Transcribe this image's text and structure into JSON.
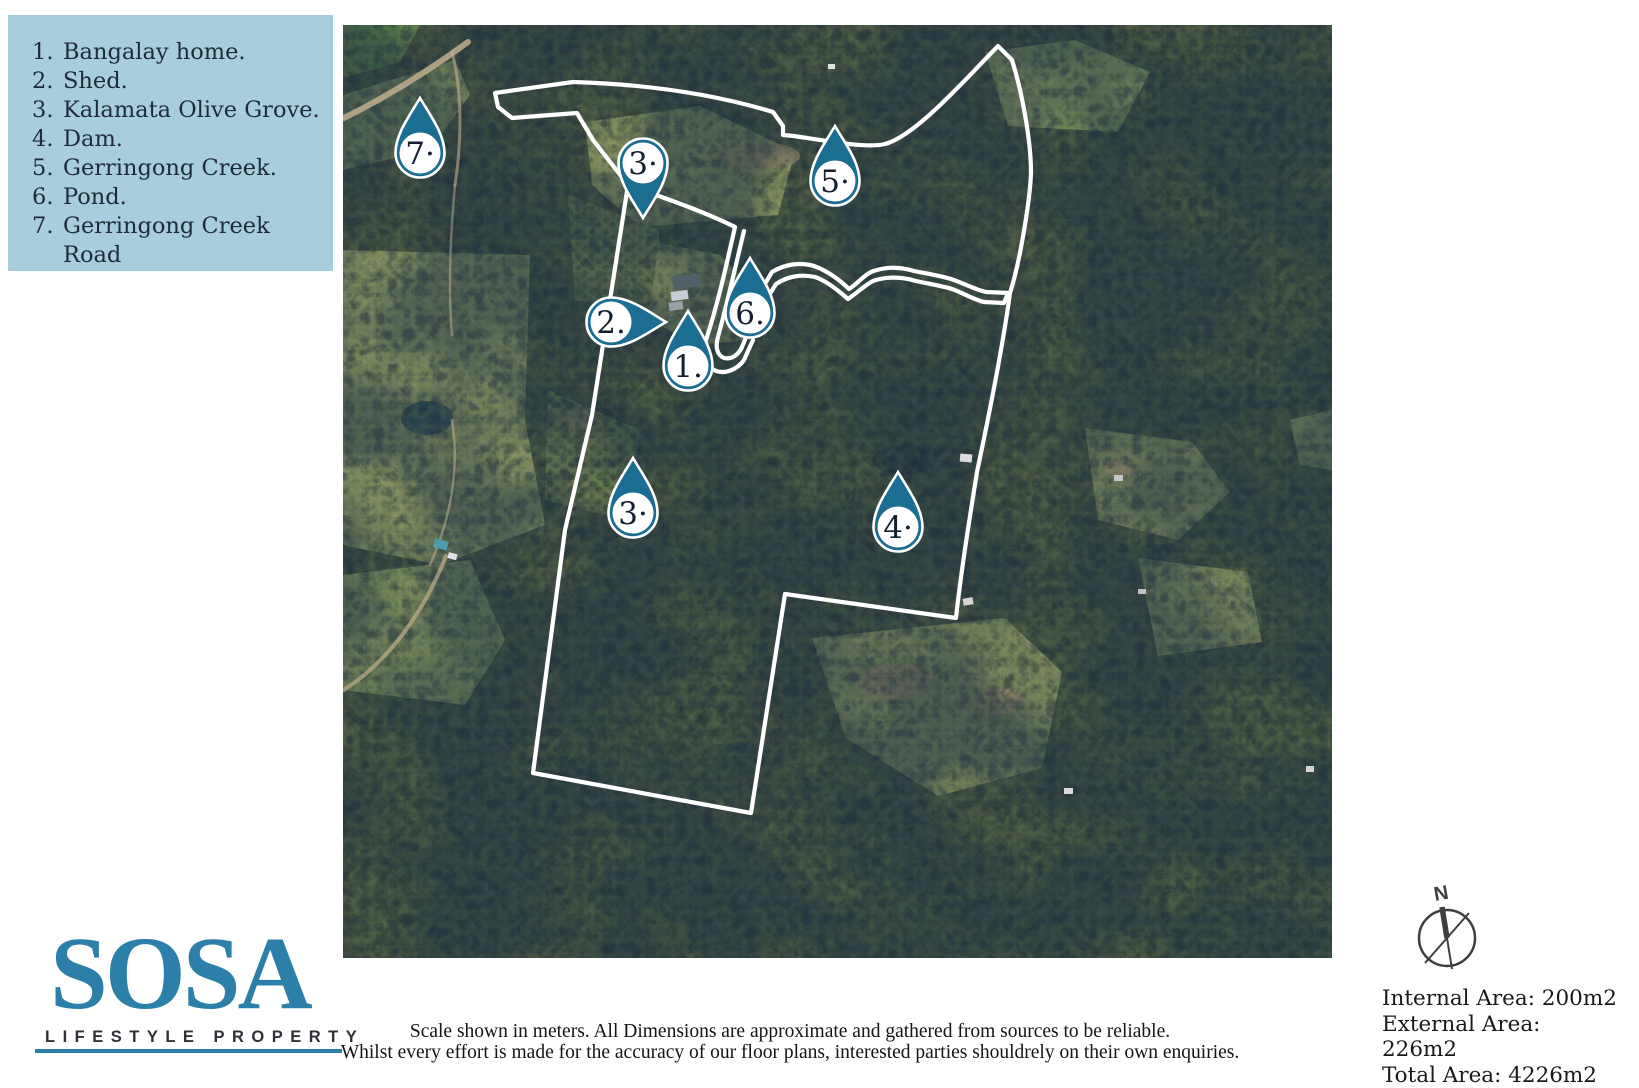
{
  "legend": {
    "bg_color": "#a8cddc",
    "items": [
      {
        "num": "1.",
        "label": "Bangalay home."
      },
      {
        "num": "2.",
        "label": "Shed."
      },
      {
        "num": "3.",
        "label": "Kalamata Olive Grove."
      },
      {
        "num": "4.",
        "label": "Dam."
      },
      {
        "num": "5.",
        "label": "Gerringong Creek."
      },
      {
        "num": "6.",
        "label": "Pond."
      },
      {
        "num": "7.",
        "label": "Gerringong Creek Road"
      }
    ]
  },
  "map": {
    "colors": {
      "pin": "#1b6d92",
      "pin_text": "#15202e",
      "boundary": "#ffffff"
    },
    "pins": [
      {
        "label": "7·",
        "x": 420,
        "y": 153,
        "dir": 0
      },
      {
        "label": "3·",
        "x": 643,
        "y": 163,
        "dir": 180
      },
      {
        "label": "5·",
        "x": 835,
        "y": 181,
        "dir": 0
      },
      {
        "label": "2.",
        "x": 611,
        "y": 322,
        "dir": 90
      },
      {
        "label": "6.",
        "x": 750,
        "y": 313,
        "dir": 0
      },
      {
        "label": "1.",
        "x": 688,
        "y": 366,
        "dir": 0
      },
      {
        "label": "3·",
        "x": 633,
        "y": 513,
        "dir": 0
      },
      {
        "label": "4·",
        "x": 898,
        "y": 527,
        "dir": 0
      }
    ]
  },
  "brand": {
    "name": "SOSA",
    "tagline": "LIFESTYLE PROPERTY",
    "accent": "#2c7fa8"
  },
  "disclaimer": {
    "line1": "Scale shown in meters. All Dimensions are approximate and gathered from sources to be reliable.",
    "line2": "Whilst every effort is made for the accuracy of our floor plans, interested parties shouldrely on their own enquiries."
  },
  "info": {
    "compass_label": "N",
    "areas": [
      "Internal Area: 200m2",
      "External Area: 226m2",
      "Total Area: 4226m2"
    ]
  }
}
